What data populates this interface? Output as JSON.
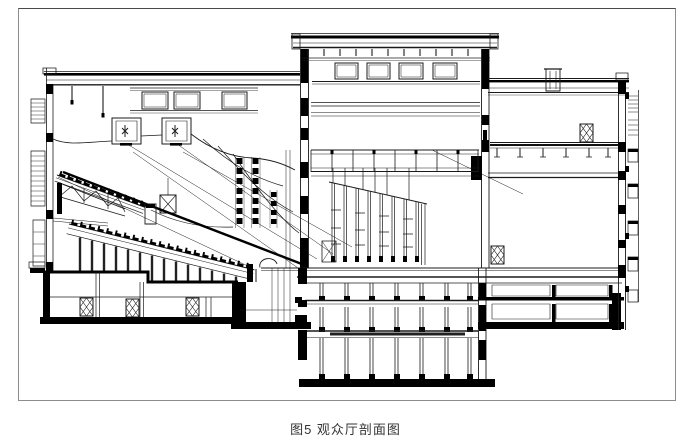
{
  "figure": {
    "caption": "图5 观众厅剖面图",
    "figure_label": "图5",
    "figure_title": "观众厅剖面图",
    "kind": "architectural-section-line-drawing"
  },
  "colors": {
    "background": "#ffffff",
    "frame_border": "#8c8c8c",
    "line": "#1b1b1b",
    "heavy": "#000000",
    "caption_text": "#333333"
  }
}
